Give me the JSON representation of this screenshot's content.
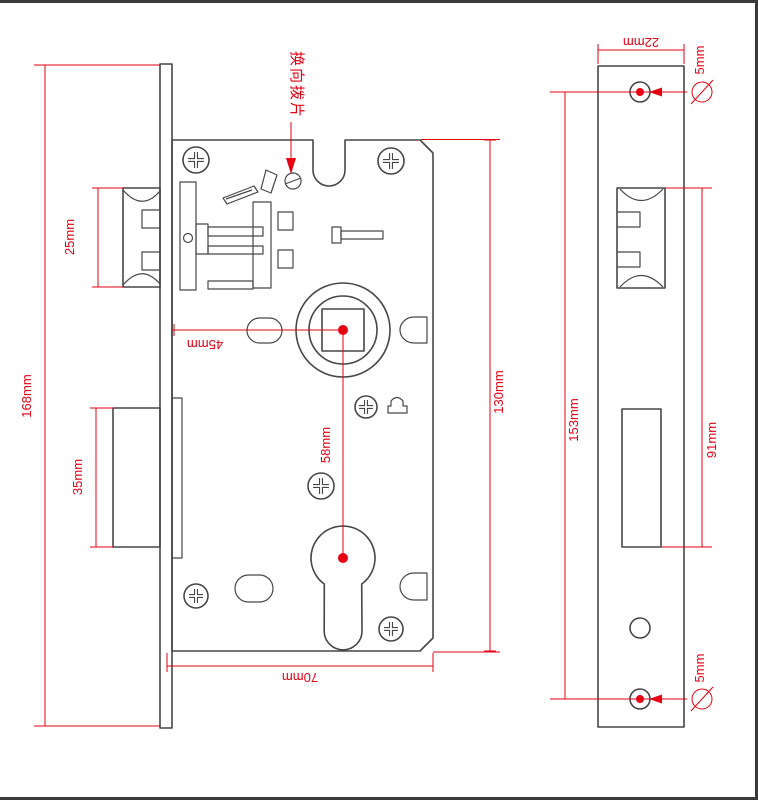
{
  "drawing": {
    "title": "Mortise lock case dimension drawing (front and edge views)",
    "unit": "mm",
    "colors": {
      "outline": "#474747",
      "dimension": "#e60012",
      "background": "#ffffff"
    },
    "note": {
      "text": "换向拨片"
    },
    "front_view": {
      "overall_height": "168mm",
      "latch_height": "25mm",
      "deadbolt_height": "35mm",
      "backset": "45mm",
      "spindle_to_cylinder": "58mm",
      "case_height": "130mm",
      "case_width": "70mm"
    },
    "side_view": {
      "faceplate_width": "22mm",
      "screw_spacing": "153mm",
      "cutout_span": "91mm",
      "screw_hole_top_dia": "5mm",
      "screw_hole_bottom_dia": "5mm"
    }
  }
}
